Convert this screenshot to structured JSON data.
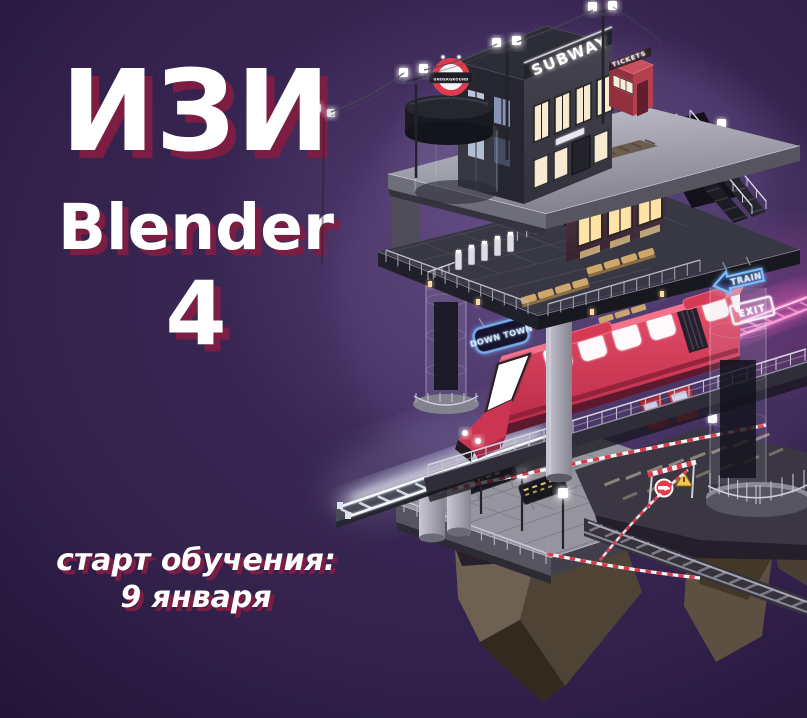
{
  "poster": {
    "title": {
      "line1": "ИЗИ",
      "line2": "Blender",
      "line3": "4"
    },
    "footer": {
      "line1": "старт обучения:",
      "line2": "9 января"
    },
    "colors": {
      "background_top": "#3f2d5c",
      "background_bottom": "#130a21",
      "title_text": "#ffffff",
      "title_shadow": "#7c1d44"
    }
  },
  "scene": {
    "signs": {
      "subway": "SUBWAY",
      "kiosk_tickets": "TICKETS",
      "underground": "UNDERGROUND",
      "tickets_neon": "TICKETS",
      "train_arrow": "TRAIN",
      "exit": "EXIT",
      "down_town": "DOWN TOWN"
    },
    "colors": {
      "neon_blue": "#7dbcff",
      "tickets_glow": "#ffcf7e",
      "train_red": "#d63a54",
      "track_pink": "#ff8fd2",
      "track_white": "#eef3ff",
      "platform_grey": "#a7a5b4",
      "rock_brown": "#6f6152",
      "caution_red": "#e03848"
    }
  }
}
